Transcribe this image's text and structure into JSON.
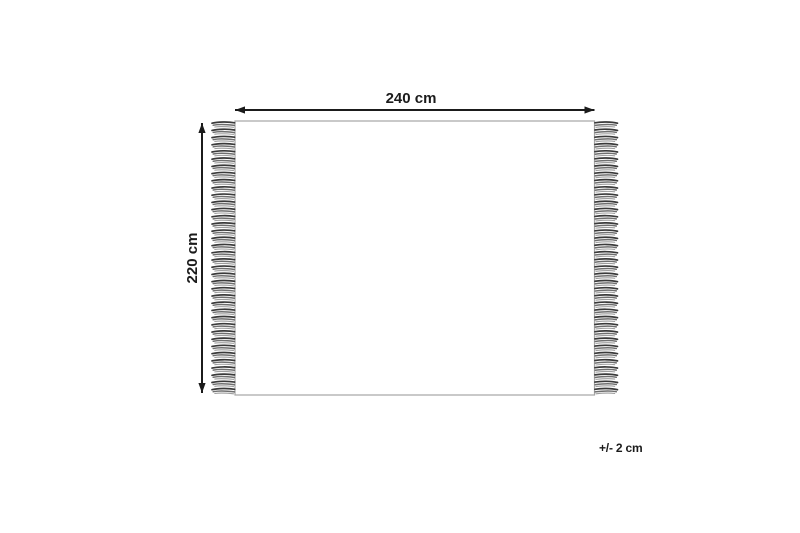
{
  "diagram": {
    "kind": "rug-dimension-diagram",
    "width_label": "240 cm",
    "height_label": "220 cm",
    "tolerance_label": "+/- 2 cm",
    "fringes": {
      "sides": [
        "left",
        "right"
      ],
      "count_per_side": 38
    },
    "colors": {
      "background": "#ffffff",
      "dimension": "#1b1b1b",
      "rug_border": "#a5a5a5",
      "fringe_dark": "#3a3a3a",
      "fringe_mid": "#6f6f6f",
      "fringe_light": "#9e9e9e"
    }
  }
}
